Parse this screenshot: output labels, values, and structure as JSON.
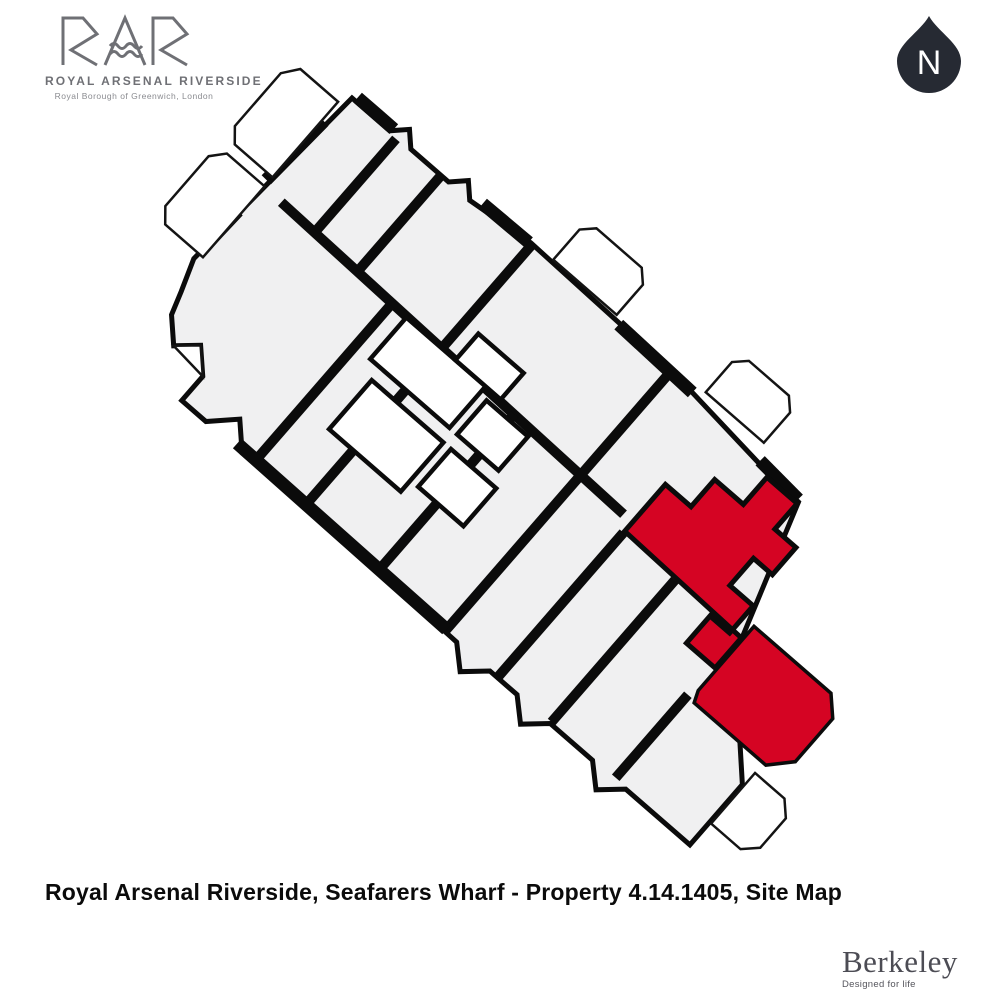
{
  "page": {
    "background": "#ffffff"
  },
  "header": {
    "logo": {
      "monogram": "RAR",
      "title": "ROYAL ARSENAL RIVERSIDE",
      "subtitle": "Royal Borough of Greenwich, London",
      "color": "#6f7075"
    },
    "compass": {
      "label": "N",
      "background": "#262a33",
      "text_color": "#ffffff"
    }
  },
  "site_map": {
    "type": "floor-plan-site-map",
    "unit_fill": "#f0f0f1",
    "wall_color": "#0b0b0b",
    "outside_color": "#ffffff",
    "highlight_color": "#d50423",
    "highlighted_unit": "Property 4.14.1405"
  },
  "footer": {
    "caption": "Royal Arsenal Riverside, Seafarers Wharf - Property 4.14.1405, Site Map",
    "brand": {
      "name": "Berkeley",
      "tagline": "Designed for life",
      "color": "#4c4c54"
    }
  }
}
